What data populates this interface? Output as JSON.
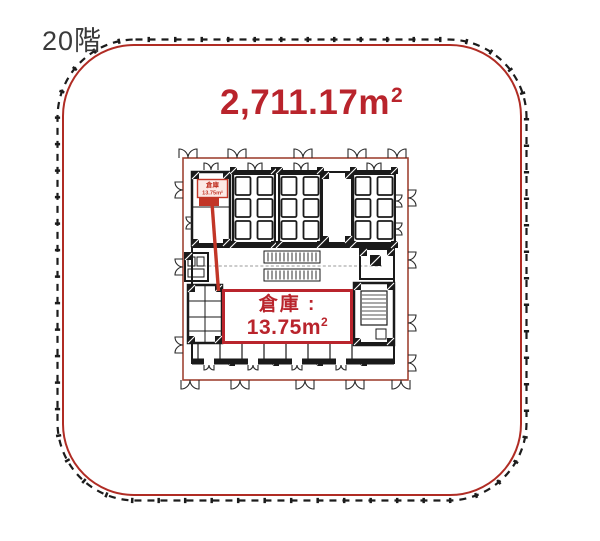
{
  "title": {
    "floor": "20階"
  },
  "area_label": {
    "value": "2,711.17",
    "unit_base": "m",
    "unit_sup": "2"
  },
  "warehouse_callout": {
    "title": "倉庫 :",
    "value": "13.75",
    "unit_base": "m",
    "unit_sup": "2"
  },
  "warehouse_marker": {
    "title": "倉庫",
    "area": "13.75m²"
  },
  "colors": {
    "accent_red": "#b9242c",
    "marker_red": "#c23627",
    "plan_border": "#a04434",
    "outline_red": "#b02c24",
    "outline_black": "#1c1c1c",
    "ink": "#1a1a1a",
    "floor_text": "#3a3a3a"
  }
}
